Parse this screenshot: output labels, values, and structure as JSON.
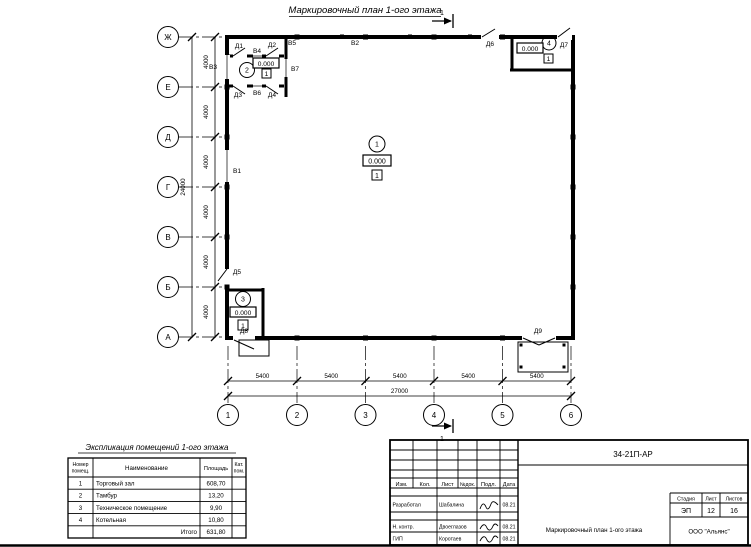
{
  "page": {
    "title": "Маркировочный план 1-ого этажа"
  },
  "section_mark": {
    "label": "1"
  },
  "axes": {
    "rows": [
      "Ж",
      "Е",
      "Д",
      "Г",
      "В",
      "Б",
      "А"
    ],
    "row_dim": "4000",
    "row_total": "24000",
    "cols": [
      "1",
      "2",
      "3",
      "4",
      "5",
      "6"
    ],
    "col_dim": "5400",
    "col_total": "27000"
  },
  "markers": {
    "room1": {
      "num": "1",
      "elev": "0.000",
      "floor": "1"
    },
    "room2": {
      "num": "2",
      "elev": "0.000",
      "floor": "1"
    },
    "room3": {
      "num": "3",
      "elev": "0.000",
      "floor": "1"
    },
    "room4": {
      "num": "4",
      "elev": "0.000",
      "floor": "1"
    }
  },
  "openings": {
    "doors": [
      "Д1",
      "Д2",
      "Д3",
      "Д4",
      "Д5",
      "Д6",
      "Д7",
      "Д8",
      "Д9"
    ],
    "windows": [
      "В1",
      "В2",
      "В3",
      "В4",
      "В5",
      "В6",
      "В7"
    ]
  },
  "explication": {
    "title": "Экспликация помещений 1-ого этажа",
    "h_num": [
      "Номер",
      "помещ."
    ],
    "h_name": "Наименование",
    "h_area": "Площадь",
    "h_cat": [
      "Кат.",
      "пом."
    ],
    "rows": [
      {
        "num": "1",
        "name": "Торговый зал",
        "area": "608,70"
      },
      {
        "num": "2",
        "name": "Тамбур",
        "area": "13,20"
      },
      {
        "num": "3",
        "name": "Техническое помещение",
        "area": "9,90"
      },
      {
        "num": "4",
        "name": "Котельная",
        "area": "10,80"
      }
    ],
    "total_label": "Итого",
    "total_area": "631,80"
  },
  "title_block": {
    "code": "34-21П-АР",
    "cols": [
      "Изм.",
      "Кол.",
      "Лист",
      "№док.",
      "Подл.",
      "Дата"
    ],
    "people": [
      {
        "role": "Разработал",
        "name": "Шабалина",
        "date": "08.21"
      },
      {
        "role": "Н. контр.",
        "name": "Двоеглазов",
        "date": "08.21"
      },
      {
        "role": "ГИП",
        "name": "Коротаев",
        "date": "08.21"
      }
    ],
    "stage_h": "Стадия",
    "sheet_h": "Лист",
    "sheets_h": "Листов",
    "stage": "ЭП",
    "sheet": "12",
    "sheets": "16",
    "doc_name": "Маркировочный план 1-ого этажа",
    "company": "ООО \"Альянс\""
  }
}
